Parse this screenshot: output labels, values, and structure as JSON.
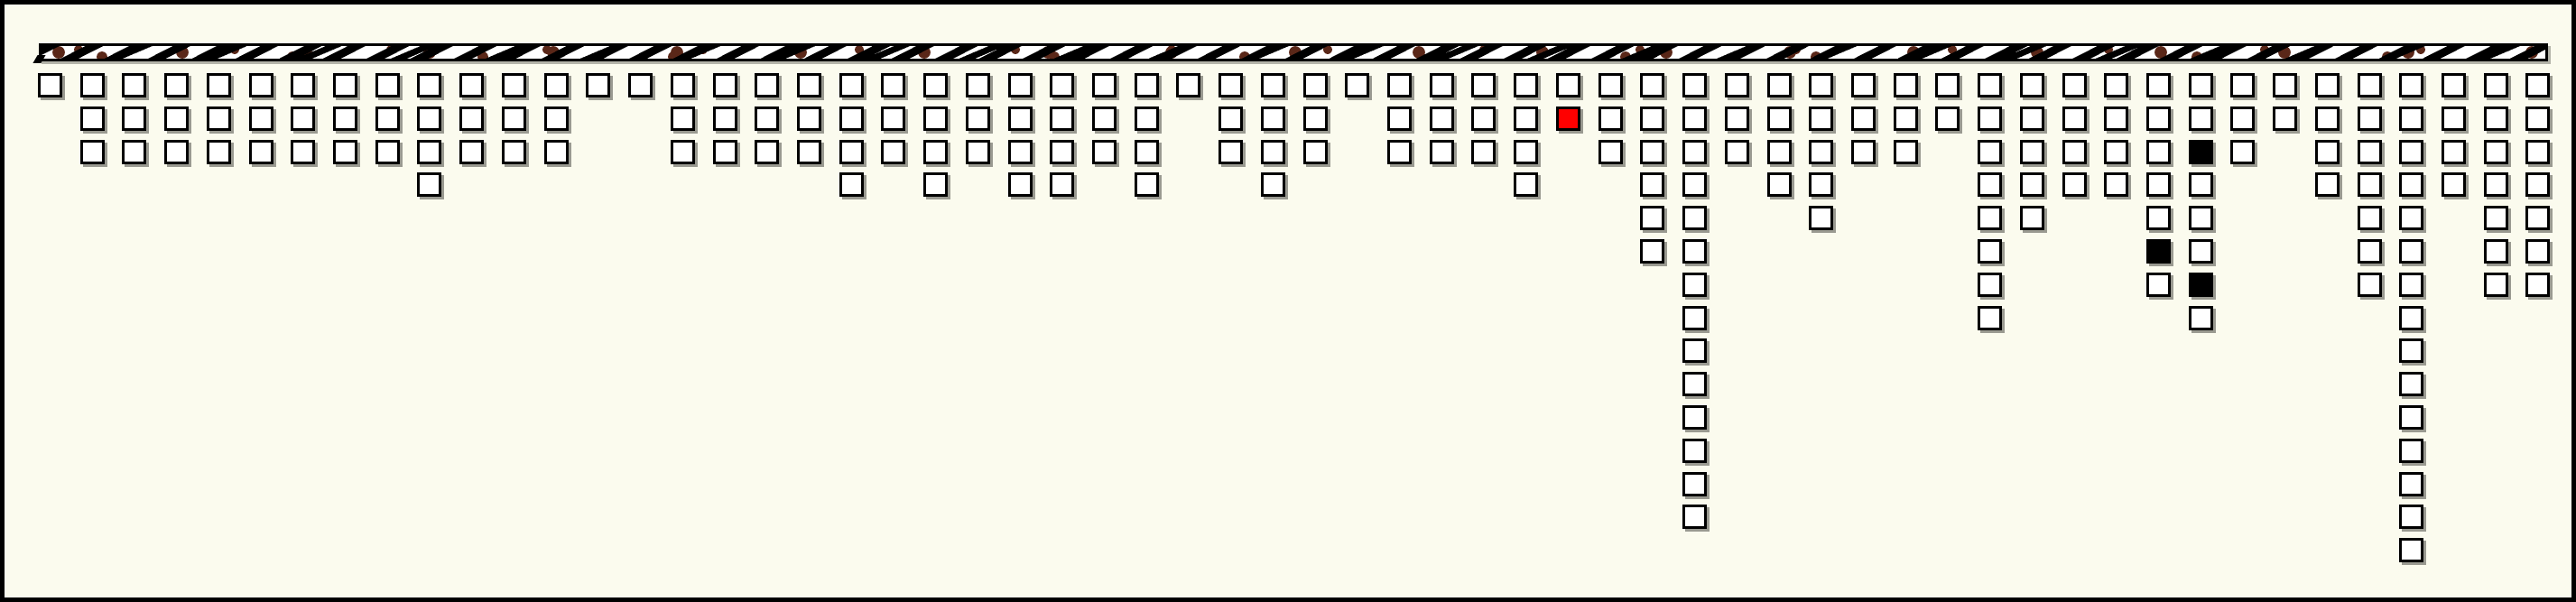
{
  "figure": {
    "background_color": "#fbfbee",
    "border_color": "#000000",
    "cell_shadow_color": "#9a9a91"
  },
  "ideogram_bar": {
    "fill_color": "#ffffff",
    "hatch_color": "#000000",
    "blob_color": "#5a2718",
    "border_color": "#000000"
  },
  "chart_data": {
    "type": "waffle-columns",
    "n_columns": 60,
    "max_column_count": 15,
    "square_counts_per_column": [
      1,
      3,
      3,
      3,
      3,
      3,
      3,
      3,
      3,
      4,
      3,
      3,
      3,
      1,
      1,
      3,
      3,
      3,
      3,
      4,
      3,
      4,
      3,
      4,
      4,
      3,
      4,
      1,
      3,
      4,
      3,
      1,
      3,
      3,
      3,
      4,
      2,
      3,
      6,
      14,
      3,
      4,
      5,
      3,
      3,
      2,
      8,
      5,
      4,
      4,
      7,
      8,
      3,
      2,
      4,
      7,
      15,
      4,
      7,
      7
    ],
    "highlight_cells": [
      {
        "column": 36,
        "row": 2,
        "color": "#ff0000"
      },
      {
        "column": 50,
        "row": 6,
        "color": "#000000"
      },
      {
        "column": 51,
        "row": 3,
        "color": "#000000"
      },
      {
        "column": 51,
        "row": 7,
        "color": "#000000"
      }
    ],
    "default_cell_color": "#ffffff",
    "cell_outline_color": "#000000",
    "legend_position": "none",
    "grid": false
  }
}
